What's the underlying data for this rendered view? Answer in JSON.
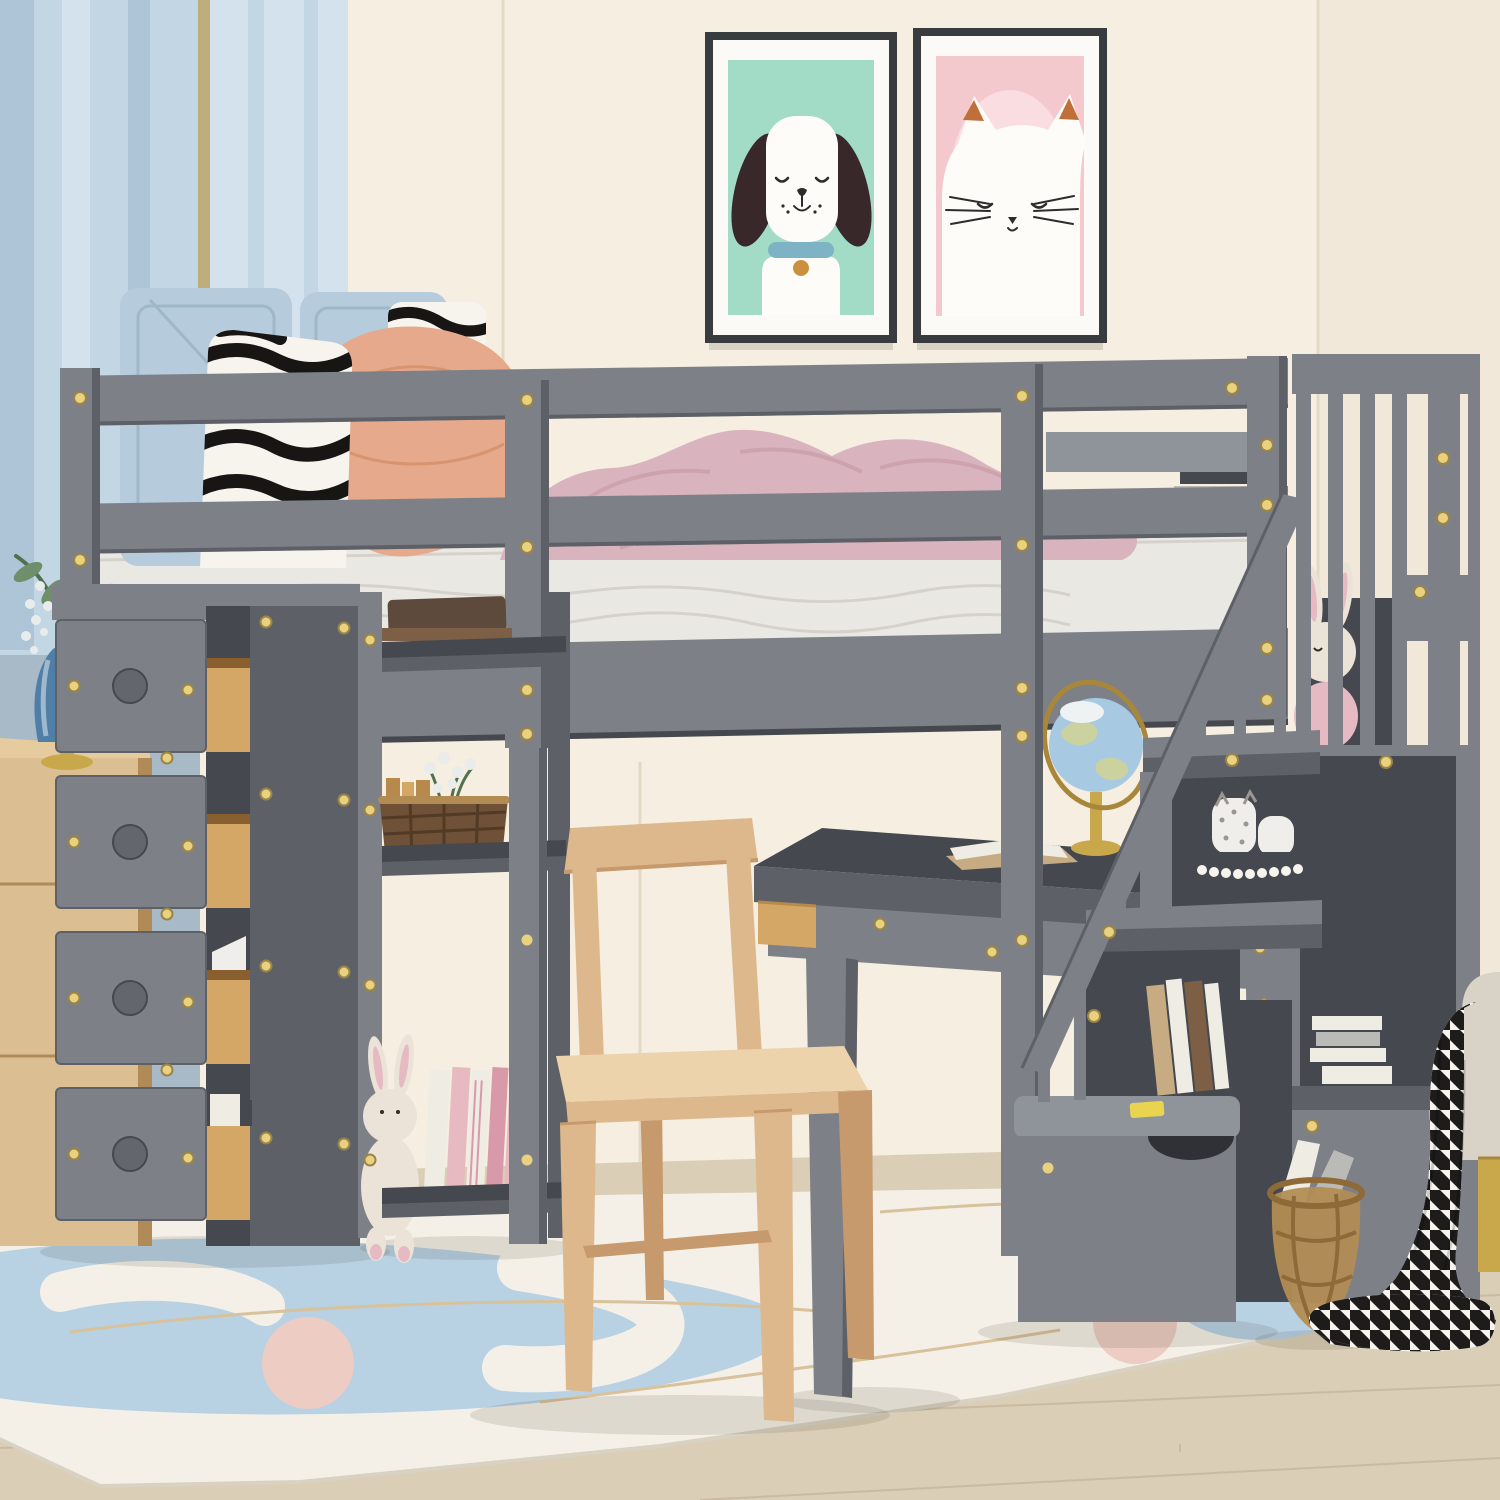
{
  "scene": {
    "type": "product-photo",
    "description": "Kids bedroom with a gray twin loft bed featuring a storage staircase, four pull-out drawers, open shelves and a built-in desk with wooden chair",
    "objects": [
      "blue curtain",
      "dog poster",
      "cat poster",
      "wooden dresser with blue vase and plant",
      "loft bed with guardrails",
      "white mattress",
      "blue pillows",
      "zebra pillows",
      "pink pillow",
      "pink blanket",
      "four-drawer storage tower with open wooden drawers",
      "open shelf unit with books, wicker basket and plush bunny",
      "gray desk with globe and open book",
      "natural wood chair",
      "storage staircase with railing, plush bunny, cat figurines and books",
      "bottom storage step drawer",
      "wicker floor basket with books",
      "houndstooth throw blanket",
      "beige ottoman with gold leg",
      "white area rug with blue and pink shapes",
      "light wood floor"
    ]
  },
  "colors": {
    "wall_cream": "#f5eee1",
    "wall_right": "#f2e8da",
    "wall_seam": "#cdbf94",
    "wall_seam_faint": "#e3dac6",
    "wall_blue": "#a8b9c8",
    "curtain_main": "#c2d6e4",
    "curtain_shadow": "#adc5d6",
    "curtain_light": "#d4e2ee",
    "curtain_trim": "#bfae7c",
    "floor_wood": "#dbceb6",
    "floor_line": "#c9baa1",
    "floor_dark": "#cfc1a9",
    "rug_white": "#f4f0e7",
    "rug_edge": "#d9d2c2",
    "rug_blue": "#b8d2e4",
    "rug_pink": "#ecccc3",
    "rug_line": "#d8c29c",
    "frame_dark": "#393c3f",
    "mat_white": "#fbfaf6",
    "poster_mint": "#a3dcc6",
    "poster_pink": "#f4c9ce",
    "poster_pink_light": "#f9dde0",
    "dog_ear": "#39282a",
    "dog_white": "#fdfcf8",
    "collar_teal": "#7eb3c5",
    "tag_gold": "#c9913e",
    "cat_ear_orange": "#c06f39",
    "line_dark": "#2e2c2a",
    "bed_gray": "#7d8187",
    "bed_gray_light": "#8f949b",
    "bed_gray_dark": "#5d6167",
    "bed_gray_deep": "#45484e",
    "knob_gray": "#63676d",
    "screw_gold": "#e8d17f",
    "screw_rim": "#9b8448",
    "mattress_white": "#eae8e3",
    "mattress_shadow": "#d5d2cb",
    "pillow_blue": "#b6ccdc",
    "pillow_blue_dark": "#9eb7c9",
    "pillow_pink": "#e6a98c",
    "pillow_pink_dark": "#d8936f",
    "zebra_white": "#f7f4ed",
    "zebra_black": "#171614",
    "hound_black": "#1d1c1b",
    "blanket_pink": "#d9b3bd",
    "blanket_pink_dark": "#c79aa8",
    "wood_drawer": "#d4a766",
    "wood_drawer_dark": "#b8894c",
    "wood_drawer_deep": "#8a5f2f",
    "oak": "#dcbe93",
    "oak_top": "#e6cb9e",
    "oak_deep": "#b08a57",
    "vase_blue": "#4f7ea6",
    "plant_green": "#6f8f6a",
    "plant_green_dark": "#51704f",
    "flower_white": "#e9ecea",
    "gold": "#c9a84c",
    "gold_dark": "#a8873a",
    "chair_wood": "#deb88d",
    "chair_wood_dark": "#c69a6c",
    "chair_wood_light": "#ecd3ab",
    "globe_blue": "#a7cae2",
    "globe_land": "#ccd1a0",
    "globe_white": "#eef2f3",
    "book_dark_brown": "#5d4a3d",
    "book_brown": "#7c5f45",
    "book_tan": "#c7ab82",
    "book_white": "#efece4",
    "book_gray": "#babbb6",
    "book_pink": "#e7bac2",
    "book_rose": "#d89aa8",
    "basket_weave": "#b38c54",
    "basket_weave_dark": "#8e6a38",
    "basket_brown": "#6e5136",
    "basket_brown_dark": "#523a24",
    "plush_cream": "#ebe3d8",
    "plush_pink": "#e6bac2",
    "figure_white": "#f0eeea",
    "figure_spot": "#9a9690",
    "ottoman": "#d9d2c7",
    "tag_yellow": "#e8d44f"
  }
}
